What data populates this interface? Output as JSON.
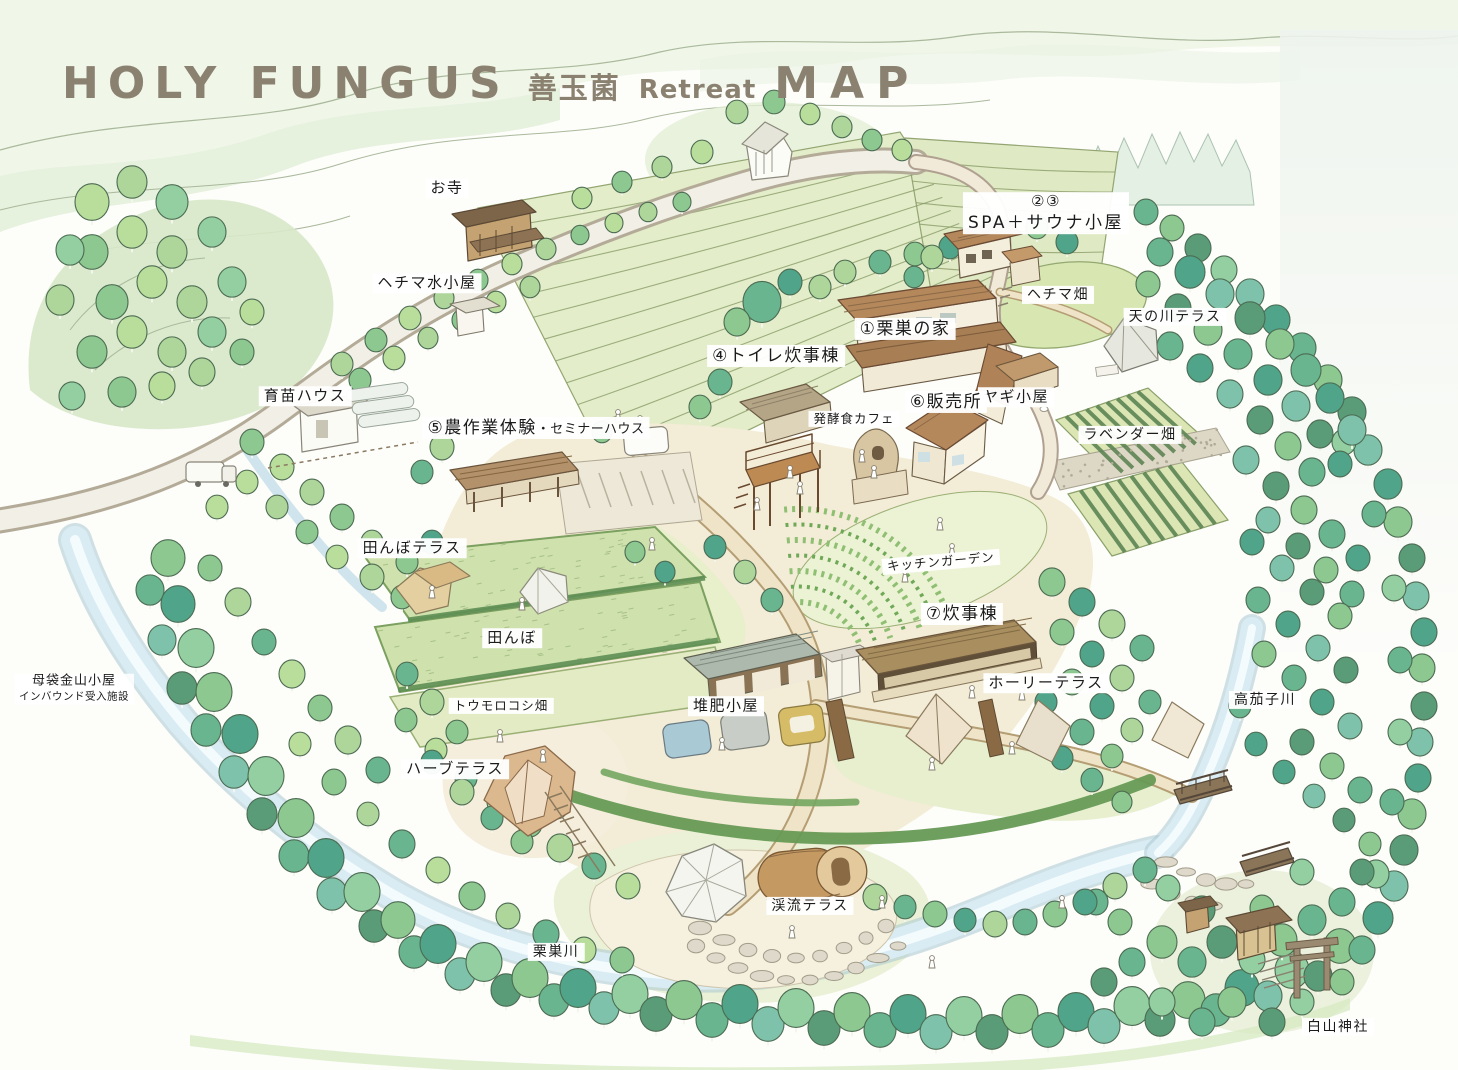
{
  "title": {
    "brand": "HOLY FUNGUS",
    "jp": "善玉菌",
    "retreat": "Retreat",
    "map_word": "MAP"
  },
  "colors": {
    "title_text": "#8b8170",
    "label_text": "#1b1b1b",
    "label_bg": "#ffffff",
    "river": "#d9ecf3",
    "road": "#f2efe6",
    "ground": "#f3ecd6",
    "foliage_light": "#aed69b",
    "foliage_teal": "#4fa489",
    "roof_brown": "#b5885c",
    "paper": "#fdfdfa"
  },
  "labels": {
    "temple": "お寺",
    "hechima_hut": "ヘチマ水小屋",
    "nursery": "育苗ハウス",
    "spa_no": "②③",
    "spa": "SPA＋サウナ小屋",
    "kurisu_house": "①栗巣の家",
    "toilet": "④トイレ炊事棟",
    "hechima_field": "ヘチマ畑",
    "amanogawa_terrace": "天の川テラス",
    "goat_hut": "ヤギ小屋",
    "farm_main": "⑤農作業体験",
    "farm_sub": "・セミナーハウス",
    "ferment_cafe": "発酵食カフェ",
    "shop": "⑥販売所",
    "lavender_field": "ラベンダー畑",
    "tanbo_terrace": "田んぼテラス",
    "kitchen_garden": "キッチンガーデン",
    "cook_hut": "⑦炊事棟",
    "tanbo": "田んぼ",
    "holy_terrace": "ホーリーテラス",
    "motai_line1": "母袋金山小屋",
    "motai_line2": "インバウンド受入施設",
    "corn_field": "トウモロコシ畑",
    "compost_hut": "堆肥小屋",
    "takanasu_river": "高茄子川",
    "herb_terrace": "ハーブテラス",
    "keiryu_terrace": "渓流テラス",
    "kurisu_river": "栗巣川",
    "hakusan_shrine": "白山神社"
  }
}
